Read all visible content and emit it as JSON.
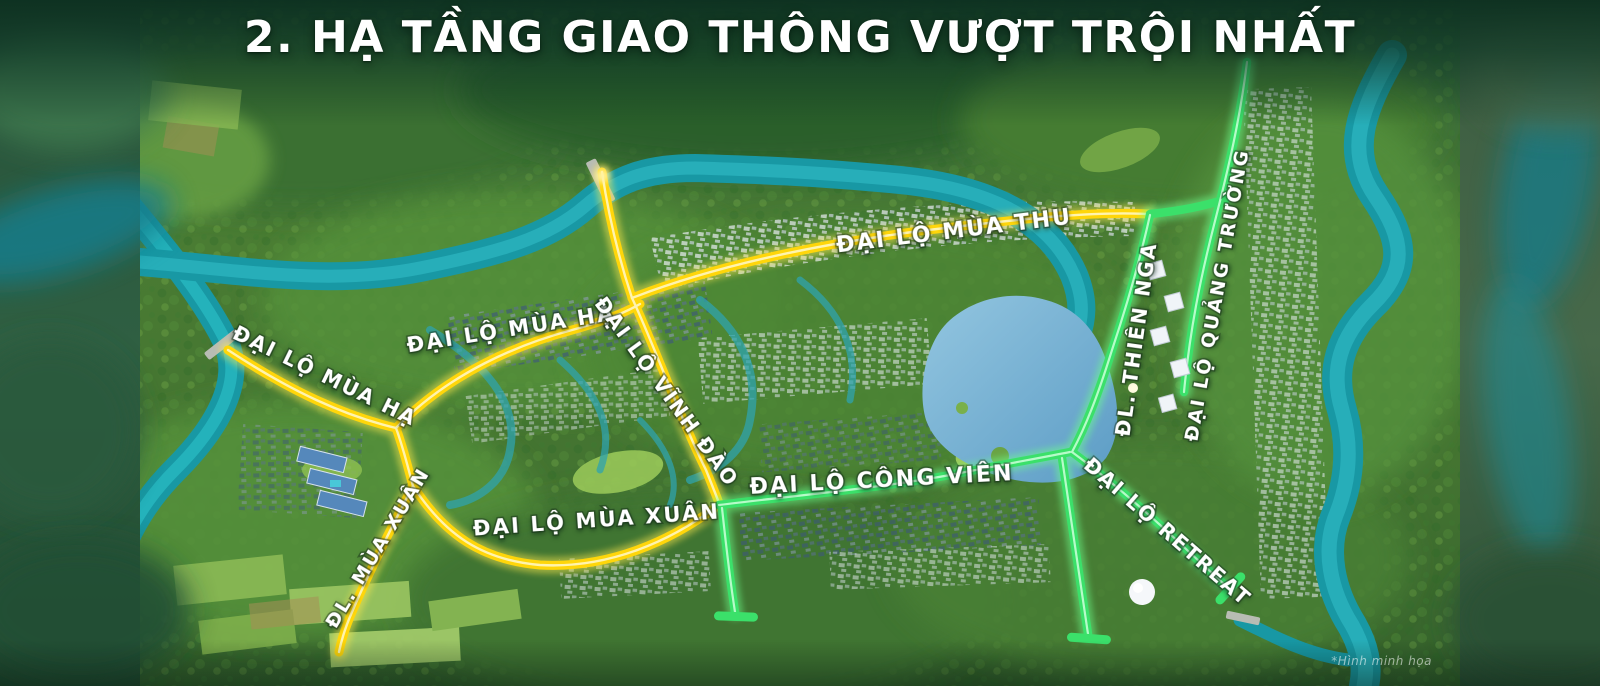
{
  "title": "2. HẠ TẦNG GIAO THÔNG VƯỢT TRỘI NHẤT",
  "disclaimer": "*Hình minh họa",
  "colors": {
    "background_dark_green": "#16452F",
    "road_yellow": "#FFD60A",
    "road_green": "#3BE06A",
    "river_teal": "#1898A4",
    "lake_blue": "#79B7D9",
    "label_text": "#FFFFFF"
  },
  "map": {
    "type": "aerial-masterplan",
    "roads": [
      {
        "label": "ĐẠI LỘ MÙA THU",
        "highlight": "yellow"
      },
      {
        "label": "ĐẠI LỘ MÙA HẠ",
        "highlight": "yellow"
      },
      {
        "label": "ĐẠI LỘ MÙA HẠ",
        "highlight": "yellow"
      },
      {
        "label": "ĐL. MÙA XUÂN",
        "highlight": "yellow"
      },
      {
        "label": "ĐẠI LỘ MÙA XUÂN",
        "highlight": "yellow"
      },
      {
        "label": "ĐẠI LỘ VĨNH ĐÀO",
        "highlight": "yellow"
      },
      {
        "label": "ĐẠI LỘ CÔNG VIÊN",
        "highlight": "green"
      },
      {
        "label": "ĐL. THIÊN NGA",
        "highlight": "green"
      },
      {
        "label": "ĐẠI LỘ QUẢNG TRƯỜNG",
        "highlight": "green"
      },
      {
        "label": "ĐẠI LỘ RETREAT",
        "highlight": "green"
      }
    ],
    "features": [
      "river",
      "central-lake",
      "bridges",
      "dome-building",
      "villa-clusters",
      "farmland"
    ]
  }
}
